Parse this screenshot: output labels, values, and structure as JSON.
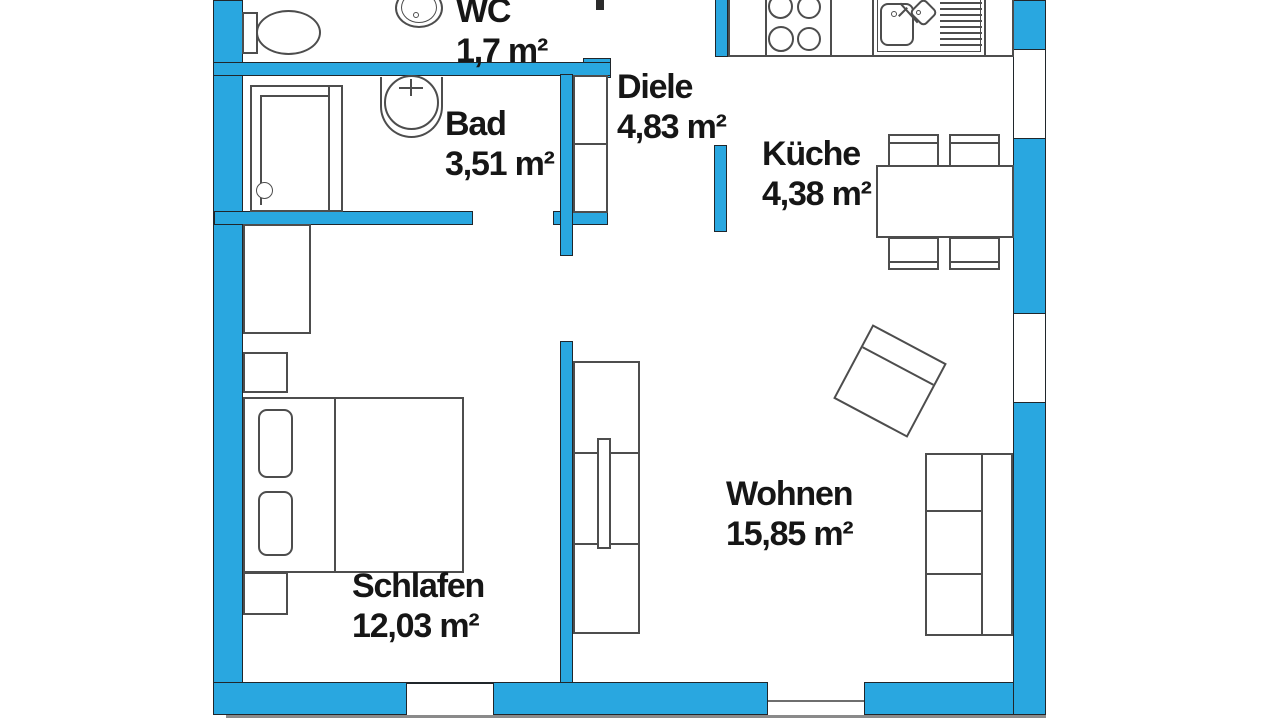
{
  "plan": {
    "rooms": [
      {
        "id": "wc",
        "name": "WC",
        "area": "1,7 m²"
      },
      {
        "id": "bad",
        "name": "Bad",
        "area": "3,51 m²"
      },
      {
        "id": "diele",
        "name": "Diele",
        "area": "4,83 m²"
      },
      {
        "id": "kueche",
        "name": "Küche",
        "area": "4,38 m²"
      },
      {
        "id": "schlafen",
        "name": "Schlafen",
        "area": "12,03 m²"
      },
      {
        "id": "wohnen",
        "name": "Wohnen",
        "area": "15,85 m²"
      }
    ],
    "colors": {
      "wall_fill": "#29a7e0",
      "wall_outline": "#20262b",
      "furniture_outline": "#4d4d4d",
      "floor": "#ffffff",
      "text": "#161616"
    },
    "furniture_icons": [
      "toilet",
      "wc-sink",
      "shower",
      "bad-sink",
      "wardrobe",
      "bed",
      "pillow",
      "nightstand",
      "stove",
      "kitchen-sink",
      "dining-table",
      "chair",
      "armchair",
      "sofa",
      "sideboard",
      "tv"
    ]
  }
}
